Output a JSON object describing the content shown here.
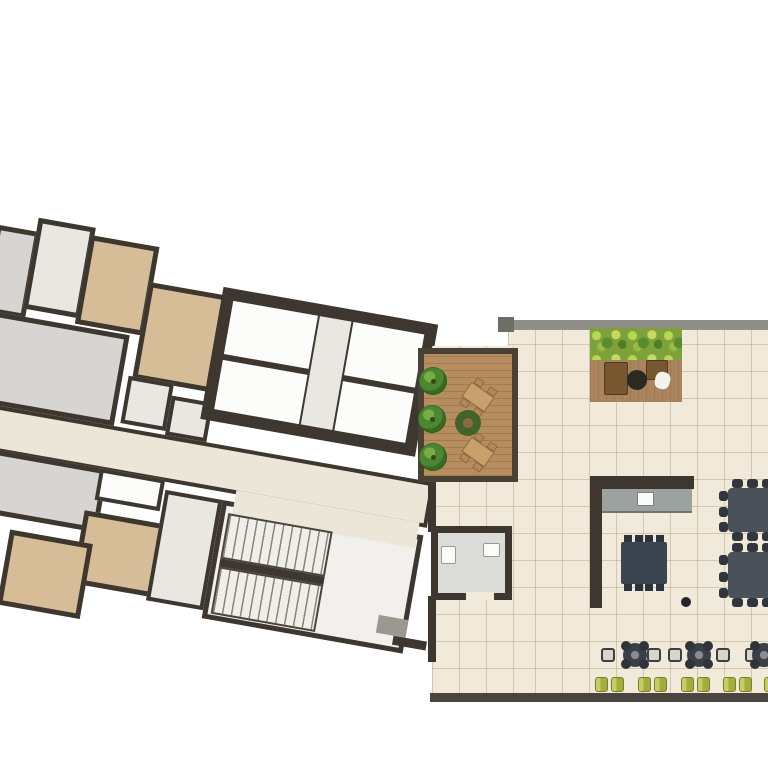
{
  "scene": {
    "width": 768,
    "height": 768,
    "background": "#ffffff",
    "description": "Architectural floor plan: rotated residential wing with elevator core and stairwell on the left, amenity terrace wing with wood deck, hedge lounge, kitchen, community tables, cafe seating and sun loungers on the right. No text labels are present in the image."
  },
  "colors": {
    "wall": "#3d372f",
    "wall_gray": "#8f8f88",
    "wall_gray_dark": "#6e6e67",
    "south_wall": "#4a463f",
    "room_gray": "#d6d5d1",
    "room_light": "#e9e7e1",
    "room_tan": "#d7bd97",
    "room_white": "#fcfcfb",
    "corridor": "#ece6d8",
    "stair_floor": "#f2f0ec",
    "tile_floor": "#f1e9da",
    "counter_gray": "#9ba29f",
    "table_dark": "#3a4550",
    "stub_dark": "#2c333c",
    "big_table": "#4b5158",
    "big_table_stub": "#31363c",
    "chair_brown": "#77572f",
    "deck_table_green": "#44622c",
    "deck_table_center": "#8a6a42",
    "set_table_tan": "#c7a06b",
    "set_chair_tan": "#b5885a",
    "mat_gray": "#9b988f",
    "bath_floor": "#dbdbd7",
    "fixture_white": "#fbfbf9"
  },
  "left_wing": {
    "rotation_deg": 10,
    "offset": {
      "x": -55,
      "y": 185
    },
    "wall_px": 5,
    "rooms": [
      {
        "name": "room-gray-top",
        "x": 58,
        "y": 30,
        "w": 44,
        "h": 88,
        "fill": "room_gray",
        "wall": 5
      },
      {
        "name": "room-light-top",
        "x": 98,
        "y": 16,
        "w": 58,
        "h": 92,
        "fill": "room_light",
        "wall": 5
      },
      {
        "name": "room-tan-top-1",
        "x": 152,
        "y": 24,
        "w": 70,
        "h": 90,
        "fill": "room_tan",
        "wall": 5
      },
      {
        "name": "room-tan-top-2",
        "x": 218,
        "y": 60,
        "w": 86,
        "h": 98,
        "fill": "room_tan",
        "wall": 5
      },
      {
        "name": "room-gray-mid",
        "x": 60,
        "y": 116,
        "w": 148,
        "h": 92,
        "fill": "room_gray",
        "wall": 5
      },
      {
        "name": "room-service-1",
        "x": 214,
        "y": 156,
        "w": 46,
        "h": 48,
        "fill": "room_light",
        "wall": 4
      },
      {
        "name": "room-service-2",
        "x": 260,
        "y": 168,
        "w": 42,
        "h": 40,
        "fill": "room_light",
        "wall": 4
      },
      {
        "name": "corridor",
        "x": 52,
        "y": 208,
        "w": 482,
        "h": 46,
        "fill": "corridor",
        "wall": 4,
        "cls": "corridor-tile"
      },
      {
        "name": "room-gray-lower",
        "x": 62,
        "y": 252,
        "w": 148,
        "h": 64,
        "fill": "room_gray",
        "wall": 5
      },
      {
        "name": "balcony-white",
        "x": 202,
        "y": 252,
        "w": 66,
        "h": 32,
        "fill": "room_white",
        "wall": 4
      },
      {
        "name": "room-tan-lower-1",
        "x": 194,
        "y": 296,
        "w": 98,
        "h": 74,
        "fill": "room_tan",
        "wall": 5
      },
      {
        "name": "room-tan-lower-2",
        "x": 124,
        "y": 328,
        "w": 84,
        "h": 76,
        "fill": "room_tan",
        "wall": 5
      },
      {
        "name": "hall-light",
        "x": 270,
        "y": 262,
        "w": 58,
        "h": 112,
        "fill": "room_light",
        "wall": 4
      },
      {
        "name": "stair-hall",
        "x": 328,
        "y": 262,
        "w": 204,
        "h": 120,
        "fill": "stair_floor",
        "wall": 5
      },
      {
        "name": "lobby-opening",
        "x": 340,
        "y": 250,
        "w": 186,
        "h": 26,
        "fill": "corridor",
        "wall": 0
      },
      {
        "name": "bottom-wall-link",
        "x": 520,
        "y": 366,
        "w": 34,
        "h": 9,
        "fill": "wall",
        "wall": 0
      }
    ],
    "core": {
      "name": "elevator-core",
      "x": 292,
      "y": 52,
      "w": 218,
      "h": 134,
      "cells": [
        {
          "name": "elevator-shaft-1",
          "x": 304,
          "y": 64,
          "w": 86,
          "h": 54,
          "fill": "room_white"
        },
        {
          "name": "elevator-shaft-2",
          "x": 304,
          "y": 124,
          "w": 86,
          "h": 50,
          "fill": "room_white"
        },
        {
          "name": "core-lobby-strip",
          "x": 392,
          "y": 64,
          "w": 32,
          "h": 110,
          "fill": "room_light"
        },
        {
          "name": "elevator-shaft-3",
          "x": 426,
          "y": 64,
          "w": 72,
          "h": 54,
          "fill": "room_white"
        },
        {
          "name": "elevator-shaft-4",
          "x": 426,
          "y": 124,
          "w": 72,
          "h": 50,
          "fill": "room_white"
        }
      ]
    },
    "stairs": {
      "flights": [
        {
          "name": "stair-flight-upper",
          "x": 336,
          "y": 274,
          "w": 106,
          "h": 46
        },
        {
          "name": "stair-flight-lower",
          "x": 336,
          "y": 328,
          "w": 106,
          "h": 48
        }
      ],
      "mid_wall": {
        "x": 336,
        "y": 320,
        "w": 106,
        "h": 8
      }
    },
    "door_mat": {
      "name": "door-mat",
      "x": 502,
      "y": 348,
      "w": 30,
      "h": 18
    }
  },
  "right_wing": {
    "floors": [
      {
        "name": "terrace-floor-main",
        "x": 508,
        "y": 328,
        "w": 260,
        "h": 368
      },
      {
        "name": "terrace-floor-west",
        "x": 432,
        "y": 346,
        "w": 86,
        "h": 350
      }
    ],
    "walls": [
      {
        "name": "north-wall",
        "x": 500,
        "y": 320,
        "w": 268,
        "h": 10,
        "fill": "wall_gray"
      },
      {
        "name": "north-wall-cap",
        "x": 498,
        "y": 317,
        "w": 16,
        "h": 15,
        "fill": "wall_gray_dark"
      },
      {
        "name": "south-wall",
        "x": 430,
        "y": 693,
        "w": 338,
        "h": 9,
        "fill": "south_wall"
      },
      {
        "name": "west-wall-upper",
        "x": 428,
        "y": 478,
        "w": 8,
        "h": 54,
        "fill": "wall"
      },
      {
        "name": "west-wall-lower",
        "x": 428,
        "y": 596,
        "w": 8,
        "h": 66,
        "fill": "wall"
      },
      {
        "name": "kitchen-wall-vertical",
        "x": 590,
        "y": 476,
        "w": 12,
        "h": 132,
        "fill": "wall"
      },
      {
        "name": "kitchen-wall-horizontal",
        "x": 590,
        "y": 476,
        "w": 104,
        "h": 13,
        "fill": "wall"
      }
    ],
    "bathroom": {
      "name": "bathroom",
      "x": 431,
      "y": 526,
      "w": 81,
      "h": 74,
      "wall": 7,
      "fixtures": [
        {
          "name": "toilet",
          "x": 441,
          "y": 546,
          "w": 15,
          "h": 18
        },
        {
          "name": "sink",
          "x": 483,
          "y": 543,
          "w": 17,
          "h": 14
        }
      ],
      "door_gap": {
        "x": 466,
        "y": 592,
        "w": 28,
        "h": 8
      }
    },
    "wood_deck": {
      "name": "wood-deck",
      "x": 418,
      "y": 348,
      "w": 100,
      "h": 134,
      "border": 6,
      "trees": [
        {
          "cx": 433,
          "cy": 381
        },
        {
          "cx": 432,
          "cy": 419
        },
        {
          "cx": 433,
          "cy": 457
        }
      ],
      "tree_r": 14,
      "table_sets": [
        {
          "cx": 478,
          "cy": 397,
          "rot": 35
        },
        {
          "cx": 478,
          "cy": 452,
          "rot": 35
        }
      ],
      "round_table": {
        "cx": 468,
        "cy": 423,
        "r": 13
      }
    },
    "hedge_lounge": {
      "name": "hedge-lounge",
      "x": 590,
      "y": 328,
      "w": 92,
      "h": 74,
      "hedge": {
        "x": 590,
        "y": 328,
        "w": 92,
        "h": 32
      },
      "chairs": [
        {
          "name": "lounge-chair-left",
          "x": 604,
          "y": 362,
          "w": 24,
          "h": 33
        },
        {
          "name": "lounge-chair-right",
          "x": 646,
          "y": 360,
          "w": 22,
          "h": 20
        }
      ],
      "table": {
        "cx": 637,
        "cy": 380,
        "r": 10
      },
      "pillow": {
        "x": 655,
        "y": 372,
        "w": 15,
        "h": 17
      }
    },
    "kitchen": {
      "counter": {
        "name": "kitchen-counter",
        "x": 602,
        "y": 489,
        "w": 90,
        "h": 24
      },
      "sink": {
        "name": "kitchen-sink",
        "x": 637,
        "y": 492,
        "w": 17,
        "h": 14
      },
      "dining_table": {
        "name": "dining-table",
        "x": 621,
        "y": 542,
        "w": 46,
        "h": 42
      },
      "stubs_per_side": 4,
      "floor_dot": {
        "cx": 686,
        "cy": 602,
        "r": 5
      }
    },
    "large_tables": [
      {
        "name": "community-table-1",
        "x": 728,
        "y": 488,
        "w": 44,
        "h": 44
      },
      {
        "name": "community-table-2",
        "x": 728,
        "y": 552,
        "w": 44,
        "h": 46
      }
    ],
    "cafe_row": {
      "chair_y": 648,
      "chair_size": 14,
      "chairs_x": [
        601,
        647,
        668,
        716,
        745
      ],
      "tables": [
        {
          "cx": 635,
          "cy": 655
        },
        {
          "cx": 699,
          "cy": 655
        },
        {
          "cx": 764,
          "cy": 655
        }
      ],
      "table_r": 12
    },
    "loungers": {
      "y": 677,
      "w": 13,
      "h": 15,
      "gap": 3,
      "pairs_x": [
        595,
        638,
        681,
        723,
        764
      ]
    }
  }
}
